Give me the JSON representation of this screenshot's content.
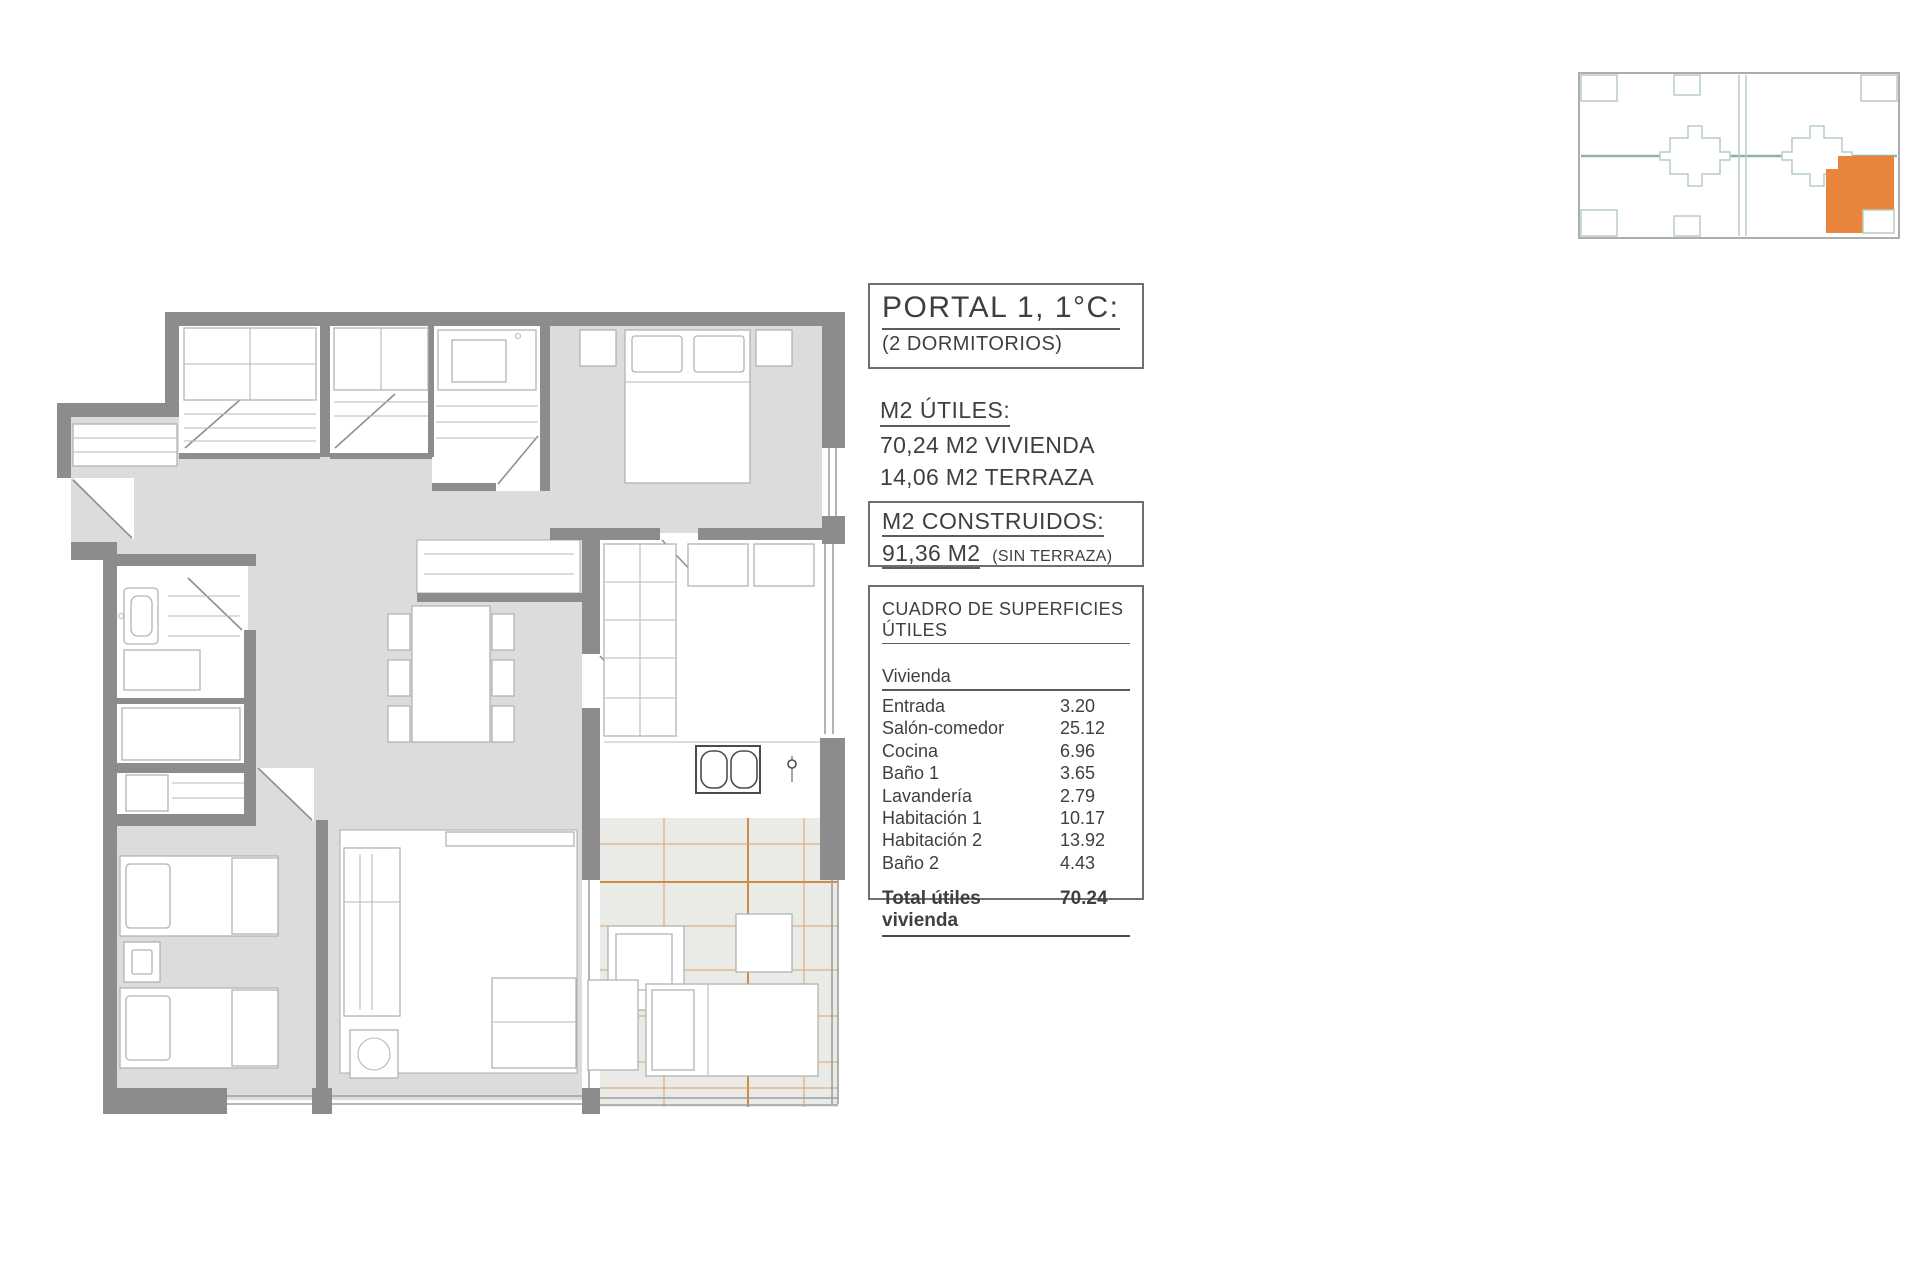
{
  "theme": {
    "accent": "#E8843C",
    "wallGray": "#8C8C8C",
    "floorGray": "#DCDCDB",
    "terraceFill": "#EAEAE7"
  },
  "title_block": {
    "title": "PORTAL 1, 1°C:",
    "subtitle": "(2 DORMITORIOS)"
  },
  "m2_utiles": {
    "heading": "M2 ÚTILES:",
    "line1": "70,24 M2 VIVIENDA",
    "line2": "14,06 M2 TERRAZA"
  },
  "m2_construidos": {
    "heading": "M2 CONSTRUIDOS:",
    "value": "91,36 M2",
    "note": "(SIN TERRAZA)"
  },
  "surface_table": {
    "heading": "CUADRO DE SUPERFICIES ÚTILES",
    "group_label": "Vivienda",
    "rows": [
      {
        "label": "Entrada",
        "value": "3.20"
      },
      {
        "label": "Salón-comedor",
        "value": "25.12"
      },
      {
        "label": "Cocina",
        "value": "6.96"
      },
      {
        "label": "Baño 1",
        "value": "3.65"
      },
      {
        "label": "Lavandería",
        "value": "2.79"
      },
      {
        "label": "Habitación 1",
        "value": "10.17"
      },
      {
        "label": "Habitación 2",
        "value": "13.92"
      },
      {
        "label": "Baño 2",
        "value": "4.43"
      }
    ],
    "total_label": "Total útiles vivienda",
    "total_value": "70.24"
  },
  "key_plan": {
    "highlighted_unit": "Portal 1, 1C (bottom-right)",
    "highlight_color": "#E8843C",
    "outline_color": "#B7CEC0"
  },
  "floor_plan": {
    "description": "2-bedroom apartment plan with terrace",
    "wall_color": "#8C8C8C",
    "floor_color": "#DCDCDB",
    "terrace_grid_color": "#CF8A46"
  }
}
